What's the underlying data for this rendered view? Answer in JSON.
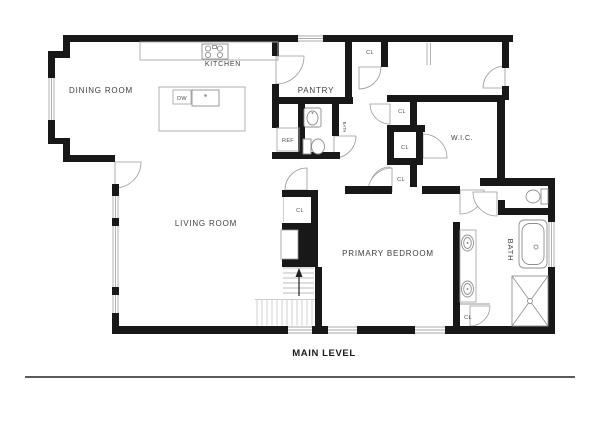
{
  "plan": {
    "title": "MAIN LEVEL",
    "labels": {
      "dining_room": "DINING ROOM",
      "kitchen": "KITCHEN",
      "pantry": "PANTRY",
      "living_room": "LIVING ROOM",
      "primary_bedroom": "PRIMARY BEDROOM",
      "wic": "W.I.C.",
      "bath": "BATH",
      "powder_bath": "BATH",
      "closet": "CL",
      "refrigerator": "REF",
      "dishwasher": "DW"
    },
    "colors": {
      "wall": "#181818",
      "label_text": "#404040",
      "divider_line": "#5a5a5a"
    }
  }
}
